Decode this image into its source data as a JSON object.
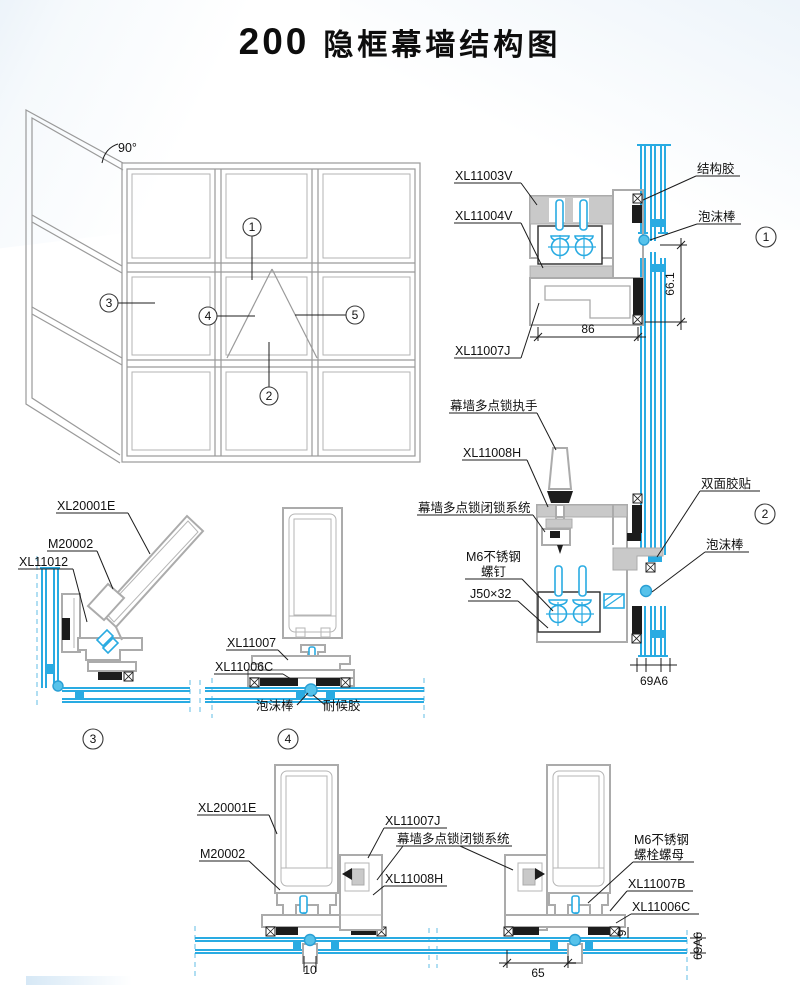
{
  "page": {
    "title_number": "200",
    "title_text": "隐框幕墙结构图"
  },
  "colors": {
    "glass": "#29abe2",
    "profile": "#ababab",
    "sealant": "#1c1c1c",
    "foam": "#56c2ea"
  },
  "elevation": {
    "angle_label": "90°",
    "callouts": [
      "1",
      "2",
      "3",
      "4",
      "5"
    ]
  },
  "detail1": {
    "number": "1",
    "label_xl11003v": "XL11003V",
    "label_xl11004v": "XL11004V",
    "label_xl11007j": "XL11007J",
    "label_structural_sealant": "结构胶",
    "label_foam_rod": "泡沫棒",
    "dim_width": "86",
    "dim_height": "66.1"
  },
  "detail2": {
    "number": "2",
    "label_handle": "幕墙多点锁执手",
    "label_xl11008h": "XL11008H",
    "label_lock_system": "幕墙多点锁闭锁系统",
    "label_m6_line1": "M6不锈钢",
    "label_m6_line2": "螺钉",
    "label_j50": "J50×32",
    "label_double_tape": "双面胶贴",
    "label_foam_rod": "泡沫棒",
    "dim_glass": "69A6"
  },
  "detail3": {
    "number": "3",
    "label_xl20001e": "XL20001E",
    "label_m20002": "M20002",
    "label_xl11012": "XL11012"
  },
  "detail4": {
    "number": "4",
    "label_xl11007": "XL11007",
    "label_xl11006c": "XL11006C",
    "label_foam_rod": "泡沫棒",
    "label_weather_sealant": "耐候胶"
  },
  "detail5": {
    "label_xl20001e": "XL20001E",
    "label_m20002": "M20002",
    "label_xl11007j": "XL11007J",
    "label_lock_system": "幕墙多点锁闭锁系统",
    "label_xl11008h": "XL11008H",
    "label_m6_line1": "M6不锈钢",
    "label_m6_line2": "螺栓螺母",
    "label_xl11007b": "XL11007B",
    "label_xl11006c": "XL11006C",
    "dim_left_gap": "10",
    "dim_right_width": "65",
    "dim_edge": "9",
    "dim_glass": "69A6"
  }
}
